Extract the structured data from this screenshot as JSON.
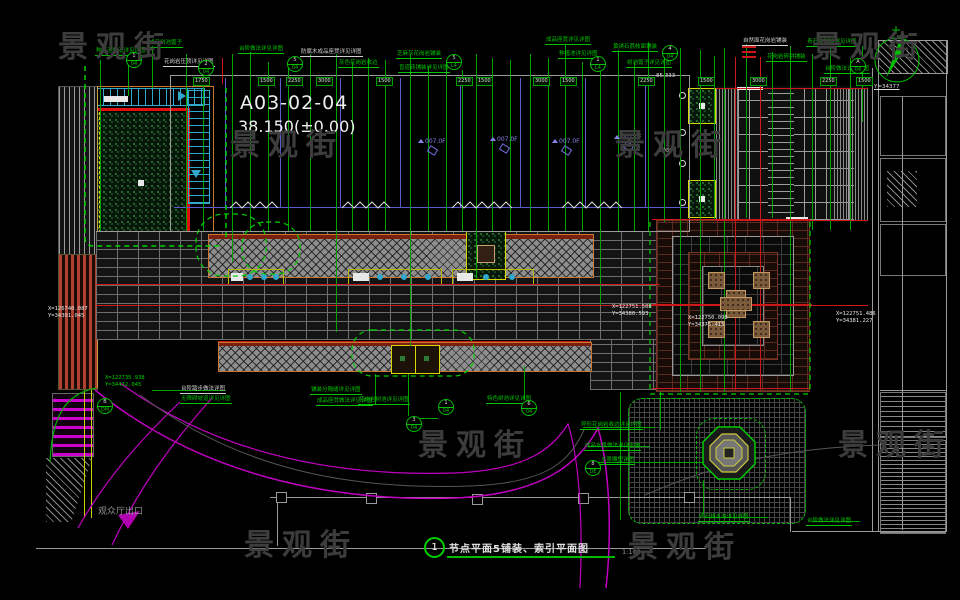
{
  "drawing": {
    "code": "A03-02-04",
    "level": "38.150(±0.00)",
    "index": "1",
    "title": "节点平面5铺装、索引平面图",
    "scale": "1:100",
    "exit": "观众厅出口",
    "north_coord": "Y=34377",
    "level_left": "85.333",
    "flag_label": "0.080",
    "room_label": "007.0F"
  },
  "watermark": {
    "text": "景观街",
    "color": "#3c3c3c",
    "positions": [
      [
        58,
        22
      ],
      [
        230,
        120
      ],
      [
        615,
        120
      ],
      [
        812,
        22
      ],
      [
        418,
        420
      ],
      [
        838,
        420
      ],
      [
        244,
        520
      ],
      [
        628,
        522
      ]
    ]
  },
  "coords": [
    {
      "x": 48,
      "y": 306,
      "l1": "X=126740.087",
      "l2": "Y=34301.045",
      "c": "#e8e8e8"
    },
    {
      "x": 105,
      "y": 375,
      "l1": "X=122735.938",
      "l2": "Y=34432.045",
      "c": "#00cc00"
    },
    {
      "x": 612,
      "y": 304,
      "l1": "X=122751.508",
      "l2": "Y=34380.593",
      "c": "#e8e8e8"
    },
    {
      "x": 688,
      "y": 315,
      "l1": "X=122750.098",
      "l2": "Y=34375.415",
      "c": "#e8e8e8"
    },
    {
      "x": 836,
      "y": 311,
      "l1": "X=122751.486",
      "l2": "Y=34381.227",
      "c": "#e8e8e8"
    }
  ],
  "top_labels": [
    {
      "x": 95,
      "y": 48,
      "t": "种植池做法详见详图"
    },
    {
      "x": 148,
      "y": 40,
      "t": "成品树池篦子"
    },
    {
      "x": 163,
      "y": 59,
      "t": "花岗岩压顶详见详图",
      "c": "w"
    },
    {
      "x": 238,
      "y": 46,
      "t": "台阶做法详见详图"
    },
    {
      "x": 300,
      "y": 49,
      "t": "防腐木成品座凳详见详图",
      "c": "w"
    },
    {
      "x": 338,
      "y": 60,
      "t": "灰色花岗岩收边"
    },
    {
      "x": 396,
      "y": 51,
      "t": "芝麻灰花岗岩铺装"
    },
    {
      "x": 398,
      "y": 65,
      "t": "盲道砖铺装详见详图"
    },
    {
      "x": 545,
      "y": 37,
      "t": "成品座凳详见详图"
    },
    {
      "x": 558,
      "y": 51,
      "t": "种植池详见详图"
    },
    {
      "x": 612,
      "y": 44,
      "t": "黄锈石荔枝面铺装"
    },
    {
      "x": 626,
      "y": 60,
      "t": "树池篦子详见详图"
    },
    {
      "x": 742,
      "y": 38,
      "t": "自然面花岗岩铺装",
      "c": "w"
    },
    {
      "x": 766,
      "y": 54,
      "t": "花岗岩碎拼铺装"
    },
    {
      "x": 806,
      "y": 39,
      "t": "青石板铺装详见详图"
    },
    {
      "x": 824,
      "y": 66,
      "t": "台阶做法详见详图"
    }
  ],
  "mid_labels": [
    {
      "x": 310,
      "y": 387,
      "t": "铺装分隔缝详见详图"
    },
    {
      "x": 316,
      "y": 398,
      "t": "成品座凳做法详见详图"
    },
    {
      "x": 358,
      "y": 397,
      "t": "花岗岩树池详见详图"
    },
    {
      "x": 486,
      "y": 396,
      "t": "特色树池详见详图"
    },
    {
      "x": 580,
      "y": 422,
      "t": "异形花岗岩收边详见详图"
    },
    {
      "x": 584,
      "y": 443,
      "t": "成品水景做法详见水施"
    },
    {
      "x": 600,
      "y": 457,
      "t": "水景雕塑详图"
    },
    {
      "x": 180,
      "y": 386,
      "t": "台阶踏步做法详图",
      "c": "w"
    },
    {
      "x": 180,
      "y": 396,
      "t": "无障碍坡道详见详图"
    },
    {
      "x": 698,
      "y": 514,
      "t": "卵石排水沟详见详图"
    },
    {
      "x": 806,
      "y": 518,
      "t": "台阶做法详见详图"
    }
  ],
  "dim_row": {
    "y": 77,
    "boxes": [
      {
        "x": 193,
        "v": "1750"
      },
      {
        "x": 258,
        "v": "1500"
      },
      {
        "x": 286,
        "v": "2250"
      },
      {
        "x": 316,
        "v": "3000"
      },
      {
        "x": 376,
        "v": "1500"
      },
      {
        "x": 456,
        "v": "2250"
      },
      {
        "x": 476,
        "v": "1500"
      },
      {
        "x": 533,
        "v": "3000"
      },
      {
        "x": 560,
        "v": "1500"
      },
      {
        "x": 638,
        "v": "2250"
      },
      {
        "x": 698,
        "v": "1500"
      },
      {
        "x": 750,
        "v": "3000"
      },
      {
        "x": 820,
        "v": "2250"
      },
      {
        "x": 856,
        "v": "1500"
      }
    ]
  },
  "bubbles": [
    {
      "x": 126,
      "y": 52,
      "a": "1",
      "b": "04"
    },
    {
      "x": 198,
      "y": 60,
      "a": "2",
      "b": "04"
    },
    {
      "x": 287,
      "y": 56,
      "a": "5",
      "b": "04"
    },
    {
      "x": 446,
      "y": 54,
      "a": "5",
      "b": "L4"
    },
    {
      "x": 590,
      "y": 56,
      "a": "1",
      "b": "L4"
    },
    {
      "x": 662,
      "y": 45,
      "a": "4",
      "b": "04"
    },
    {
      "x": 850,
      "y": 58,
      "a": "A",
      "b": "04"
    },
    {
      "x": 438,
      "y": 399,
      "a": "1",
      "b": "04"
    },
    {
      "x": 521,
      "y": 400,
      "a": "6",
      "b": "04"
    },
    {
      "x": 585,
      "y": 460,
      "a": "8",
      "b": "DE"
    },
    {
      "x": 97,
      "y": 398,
      "a": "B",
      "b": "DM"
    },
    {
      "x": 406,
      "y": 416,
      "a": "3",
      "b": "04"
    }
  ],
  "rooms": [
    [
      418,
      138
    ],
    [
      490,
      136
    ],
    [
      552,
      138
    ],
    [
      614,
      134
    ]
  ],
  "column_squares": [
    [
      276,
      492
    ],
    [
      366,
      493
    ],
    [
      472,
      494
    ],
    [
      578,
      493
    ],
    [
      684,
      492
    ]
  ],
  "tan_squares": [
    [
      708,
      272
    ],
    [
      753,
      272
    ],
    [
      708,
      321
    ],
    [
      753,
      321
    ]
  ],
  "geometry": {
    "green_v": [
      [
        100,
        60,
        231
      ],
      [
        128,
        64,
        96
      ],
      [
        152,
        46,
        88
      ],
      [
        186,
        54,
        231
      ],
      [
        203,
        62,
        231
      ],
      [
        232,
        54,
        262
      ],
      [
        250,
        52,
        231
      ],
      [
        268,
        62,
        231
      ],
      [
        288,
        66,
        231
      ],
      [
        310,
        54,
        231
      ],
      [
        336,
        54,
        332
      ],
      [
        352,
        62,
        231
      ],
      [
        368,
        58,
        231
      ],
      [
        385,
        60,
        231
      ],
      [
        410,
        54,
        346
      ],
      [
        428,
        66,
        231
      ],
      [
        446,
        60,
        231
      ],
      [
        462,
        70,
        231
      ],
      [
        476,
        54,
        278
      ],
      [
        492,
        58,
        231
      ],
      [
        510,
        60,
        231
      ],
      [
        530,
        54,
        231
      ],
      [
        548,
        58,
        231
      ],
      [
        565,
        44,
        231
      ],
      [
        582,
        62,
        231
      ],
      [
        600,
        64,
        306
      ],
      [
        618,
        50,
        231
      ],
      [
        634,
        62,
        231
      ],
      [
        648,
        42,
        231
      ],
      [
        664,
        52,
        222
      ],
      [
        680,
        48,
        392
      ],
      [
        700,
        50,
        392
      ],
      [
        714,
        56,
        220
      ],
      [
        724,
        48,
        392
      ],
      [
        746,
        44,
        218
      ],
      [
        772,
        52,
        218
      ],
      [
        790,
        46,
        392
      ],
      [
        812,
        54,
        230
      ],
      [
        830,
        48,
        230
      ],
      [
        850,
        58,
        230
      ],
      [
        862,
        46,
        122
      ],
      [
        375,
        374,
        404
      ],
      [
        408,
        374,
        416
      ],
      [
        524,
        366,
        400
      ],
      [
        620,
        392,
        520
      ],
      [
        660,
        392,
        430
      ],
      [
        703,
        480,
        514
      ]
    ],
    "green_h": [
      [
        598,
        462,
        710
      ],
      [
        583,
        427,
        655
      ],
      [
        588,
        446,
        650
      ],
      [
        412,
        418,
        438
      ],
      [
        152,
        390,
        226
      ],
      [
        704,
        517,
        768
      ],
      [
        812,
        521,
        860
      ]
    ],
    "red_v": [
      [
        735,
        57,
        390
      ],
      [
        760,
        57,
        390
      ],
      [
        222,
        58,
        84
      ]
    ],
    "red_h": [
      [
        96,
        284,
        660
      ],
      [
        96,
        305,
        868
      ],
      [
        218,
        341,
        590
      ],
      [
        652,
        219,
        810
      ],
      [
        652,
        388,
        810
      ],
      [
        716,
        88,
        868
      ],
      [
        716,
        220,
        868
      ],
      [
        652,
        304,
        812
      ]
    ],
    "red_ticks": [
      [
        742,
        46
      ],
      [
        742,
        51
      ],
      [
        742,
        56
      ]
    ],
    "gray_h": [
      [
        170,
        75,
        690
      ],
      [
        96,
        231,
        690
      ],
      [
        270,
        497,
        790
      ],
      [
        36,
        548,
        706
      ],
      [
        792,
        531,
        946
      ],
      [
        880,
        390,
        946
      ]
    ],
    "gray_v": [
      [
        170,
        75,
        231
      ],
      [
        689,
        75,
        231
      ],
      [
        277,
        497,
        546
      ],
      [
        790,
        497,
        532
      ],
      [
        872,
        68,
        532
      ],
      [
        878,
        68,
        532
      ],
      [
        946,
        40,
        532
      ],
      [
        902,
        96,
        530
      ]
    ],
    "blue_v": [
      [
        225,
        78,
        207
      ],
      [
        280,
        78,
        207
      ],
      [
        340,
        78,
        207
      ],
      [
        400,
        78,
        207
      ],
      [
        460,
        78,
        207
      ],
      [
        520,
        78,
        207
      ],
      [
        585,
        78,
        207
      ],
      [
        645,
        78,
        207
      ]
    ],
    "blue_h": [
      [
        174,
        207,
        688
      ]
    ]
  },
  "colors": {
    "green": "#00a400",
    "red": "#cc1818",
    "gray": "#9a9a9a",
    "blue": "#5c5cd0",
    "magenta": "#c000c0",
    "cyan": "#2fa8cc",
    "yellow": "#d8d800",
    "orange": "#c87830"
  }
}
